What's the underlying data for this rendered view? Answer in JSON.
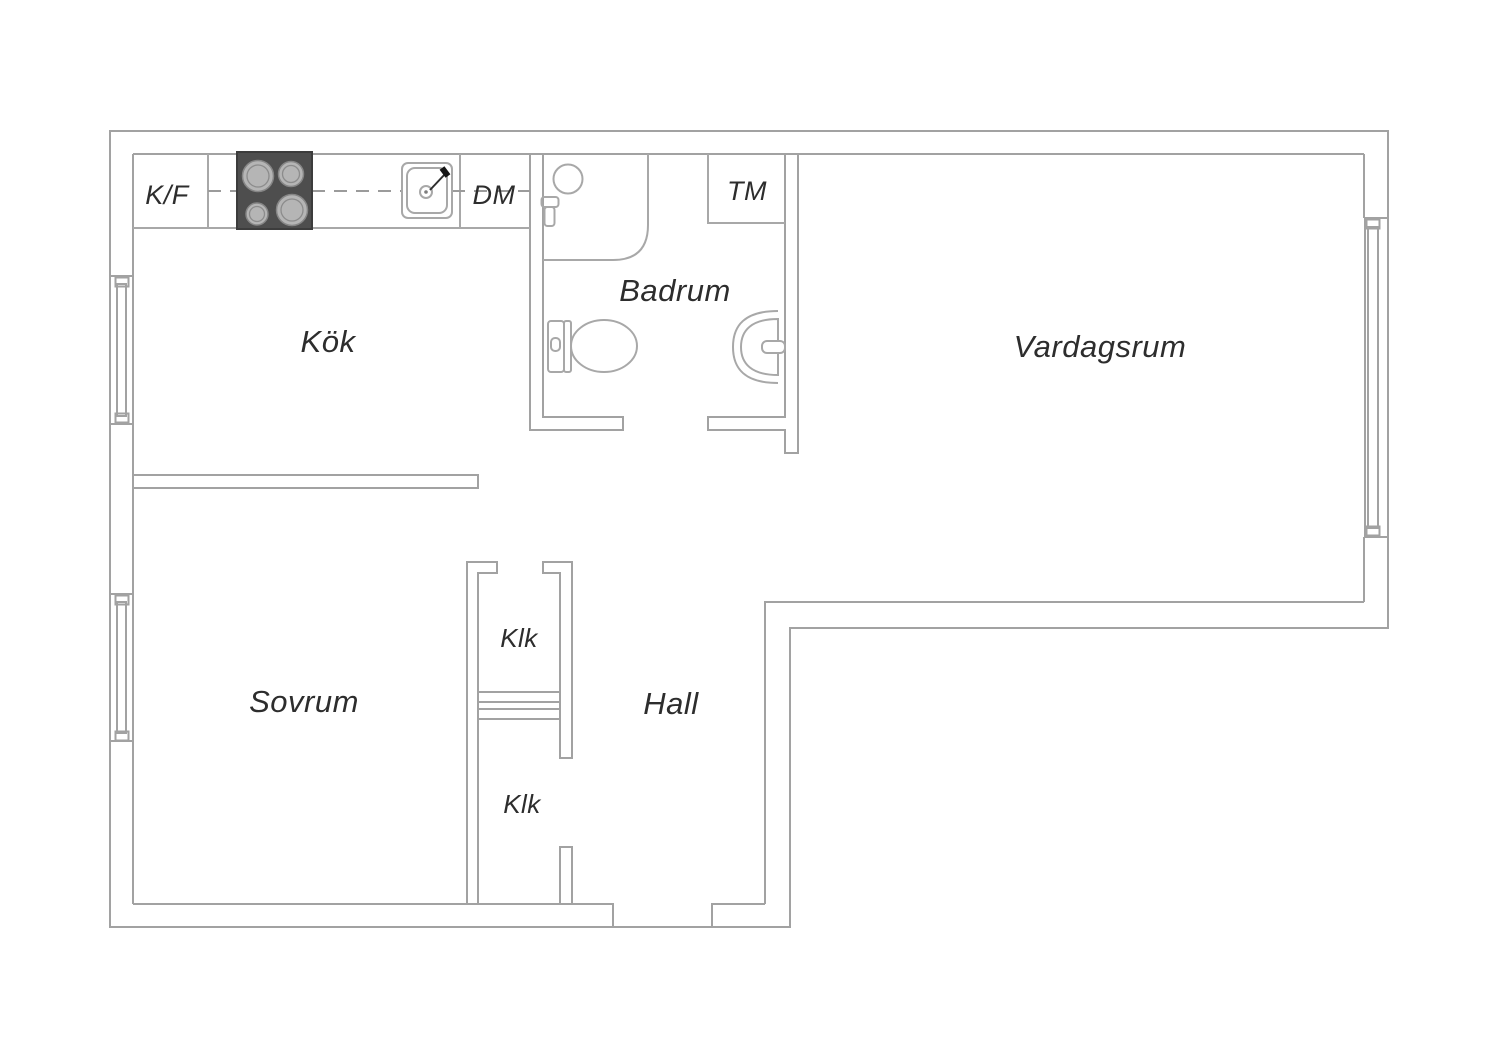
{
  "title": "Apartment floor plan",
  "colors": {
    "background": "#ffffff",
    "wall_line": "#a2a2a2",
    "fixture_line": "#a8a8a8",
    "dashed_line": "#9b9b9b",
    "label_text": "#2d2d2d",
    "stove_fill": "#4e4e4e",
    "burner_fill": "#b5b5b5"
  },
  "labels": {
    "kitchen": "Kök",
    "bathroom": "Badrum",
    "living_room": "Vardagsrum",
    "bedroom": "Sovrum",
    "closet_upper": "Klk",
    "closet_lower": "Klk",
    "hall": "Hall",
    "fridge_freezer": "K/F",
    "dishwasher": "DM",
    "washing_machine": "TM"
  }
}
